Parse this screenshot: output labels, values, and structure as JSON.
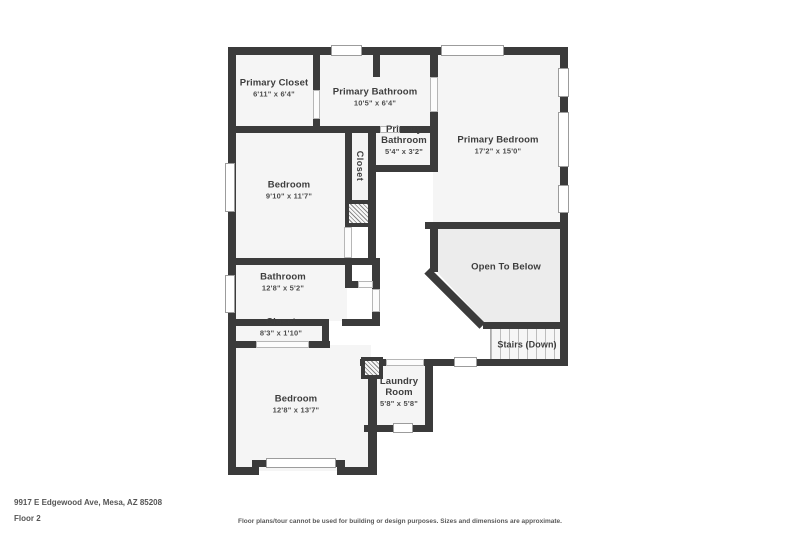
{
  "floorplan": {
    "rooms": {
      "primary_closet": {
        "name": "Primary Closet",
        "dims": "6'11\" x 6'4\""
      },
      "primary_bathroom": {
        "name": "Primary Bathroom",
        "dims": "10'5\" x 6'4\""
      },
      "primary_bathroom_wc": {
        "name": "Primary Bathroom",
        "dims": "5'4\" x 3'2\""
      },
      "hall_closet": {
        "name": "Closet"
      },
      "primary_bedroom": {
        "name": "Primary Bedroom",
        "dims": "17'2\" x 15'0\""
      },
      "bedroom_mid": {
        "name": "Bedroom",
        "dims": "9'10\" x 11'7\""
      },
      "open_to_below": {
        "name": "Open To Below"
      },
      "bathroom": {
        "name": "Bathroom",
        "dims": "12'8\" x 5'2\""
      },
      "closet_low": {
        "name": "Closet",
        "dims": "8'3\" x 1'10\""
      },
      "stairs": {
        "name": "Stairs (Down)"
      },
      "bedroom_low": {
        "name": "Bedroom",
        "dims": "12'8\" x 13'7\""
      },
      "laundry": {
        "name": "Laundry Room",
        "dims": "5'8\" x 5'8\""
      }
    },
    "footer": {
      "address": "9917 E Edgewood Ave, Mesa, AZ 85208",
      "floor_label": "Floor 2",
      "disclaimer": "Floor plans/tour cannot be used for building or design purposes. Sizes and dimensions are approximate."
    },
    "colors": {
      "wall": "#3b3b3b",
      "room_fill": "#f5f5f5",
      "open_below_fill": "#ececec",
      "background": "#ffffff"
    }
  }
}
